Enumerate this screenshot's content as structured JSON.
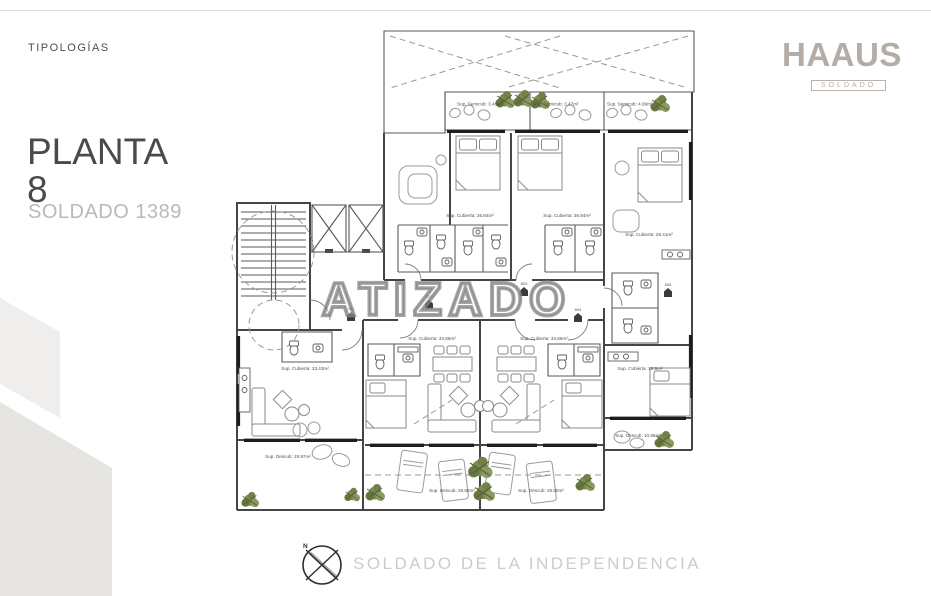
{
  "header": {
    "eyebrow": "TIPOLOGÍAS",
    "title_line1": "PLANTA",
    "title_line2": "8",
    "subtitle": "SOLDADO 1389"
  },
  "brand": {
    "logo": "HAAUS",
    "badge": "SOLDADO"
  },
  "watermark": {
    "text": "ATIZADO"
  },
  "plan": {
    "units": [
      "801",
      "802",
      "803",
      "804",
      "805"
    ],
    "area_labels": {
      "semicub_1": "Sup. Semicub: 3.46m²",
      "semicub_2": "Sup. Semicub: 3.47m²",
      "semicub_3": "Sup. Semicub: 4.99m²",
      "cubierta_up_1": "Sup. Cubierta: 36.84m²",
      "cubierta_up_2": "Sup. Cubierta: 36.84m²",
      "cubierta_right_up": "Sup. Cubierta: 29.41m²",
      "cubierta_left": "Sup. Cubierta: 33.43m²",
      "cubierta_mid_1": "Sup. Cubierta: 33.86m²",
      "cubierta_mid_2": "Sup. Cubierta: 33.86m²",
      "cubierta_right_low": "Sup. Cubierta: 18.9m²",
      "descub_left": "Sup. Descub: 19.97m²",
      "descub_mid_1": "Sup. Descub: 28.80m²",
      "descub_mid_2": "Sup. Descub: 28.80m²",
      "descub_right": "Sup. Descub: 10.65m²"
    },
    "colors": {
      "wall": "#454545",
      "window": "#1d1d1d",
      "plant_green": "#7e8e52",
      "watermark_gray": "#909090"
    }
  },
  "footer": {
    "compass_north": "N",
    "street": "SOLDADO DE LA INDEPENDENCIA"
  }
}
